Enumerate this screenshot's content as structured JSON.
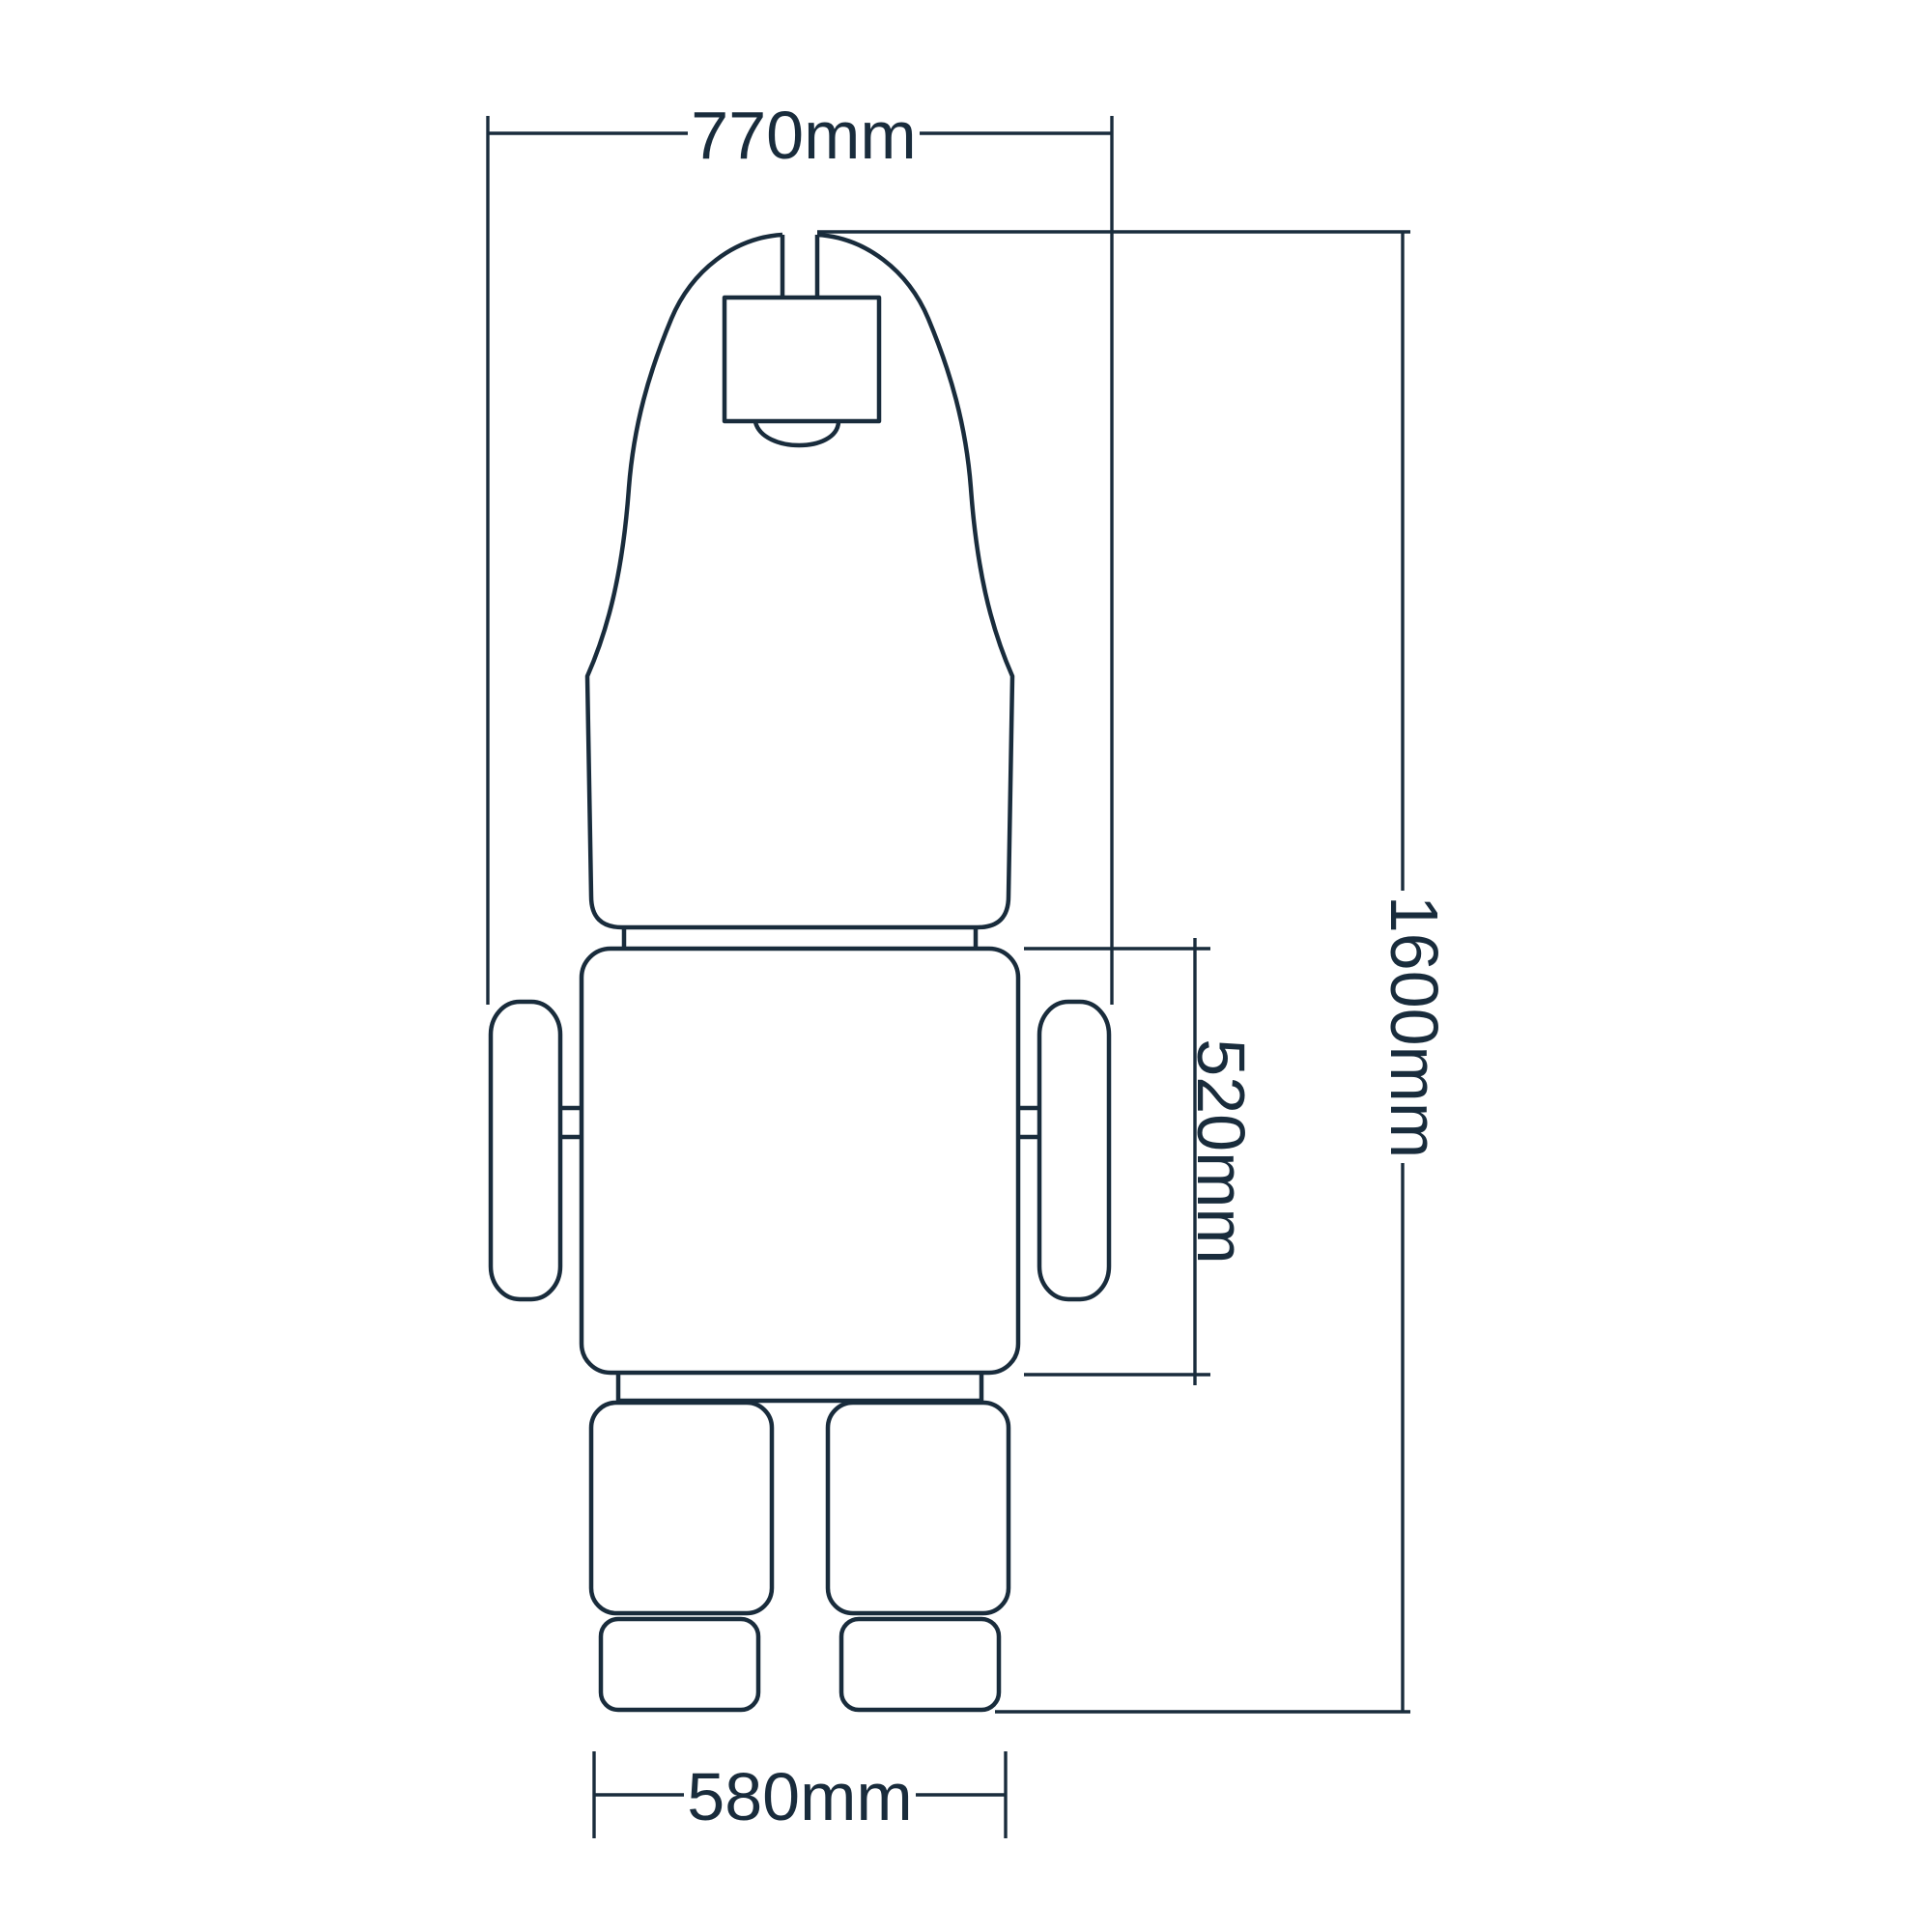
{
  "diagram": {
    "subject": "examination-chair-top-view-dimension-drawing",
    "background_color": "#ffffff",
    "line_color": "#192c3c",
    "labels": {
      "overall_width": "770mm",
      "overall_length": "1600mm",
      "seat_length": "520mm",
      "footrest_width": "580mm"
    },
    "parts": [
      "headrest",
      "backrest",
      "seat",
      "left-armrest",
      "right-armrest",
      "left-legrest",
      "right-legrest",
      "left-footrest",
      "right-footrest"
    ]
  }
}
